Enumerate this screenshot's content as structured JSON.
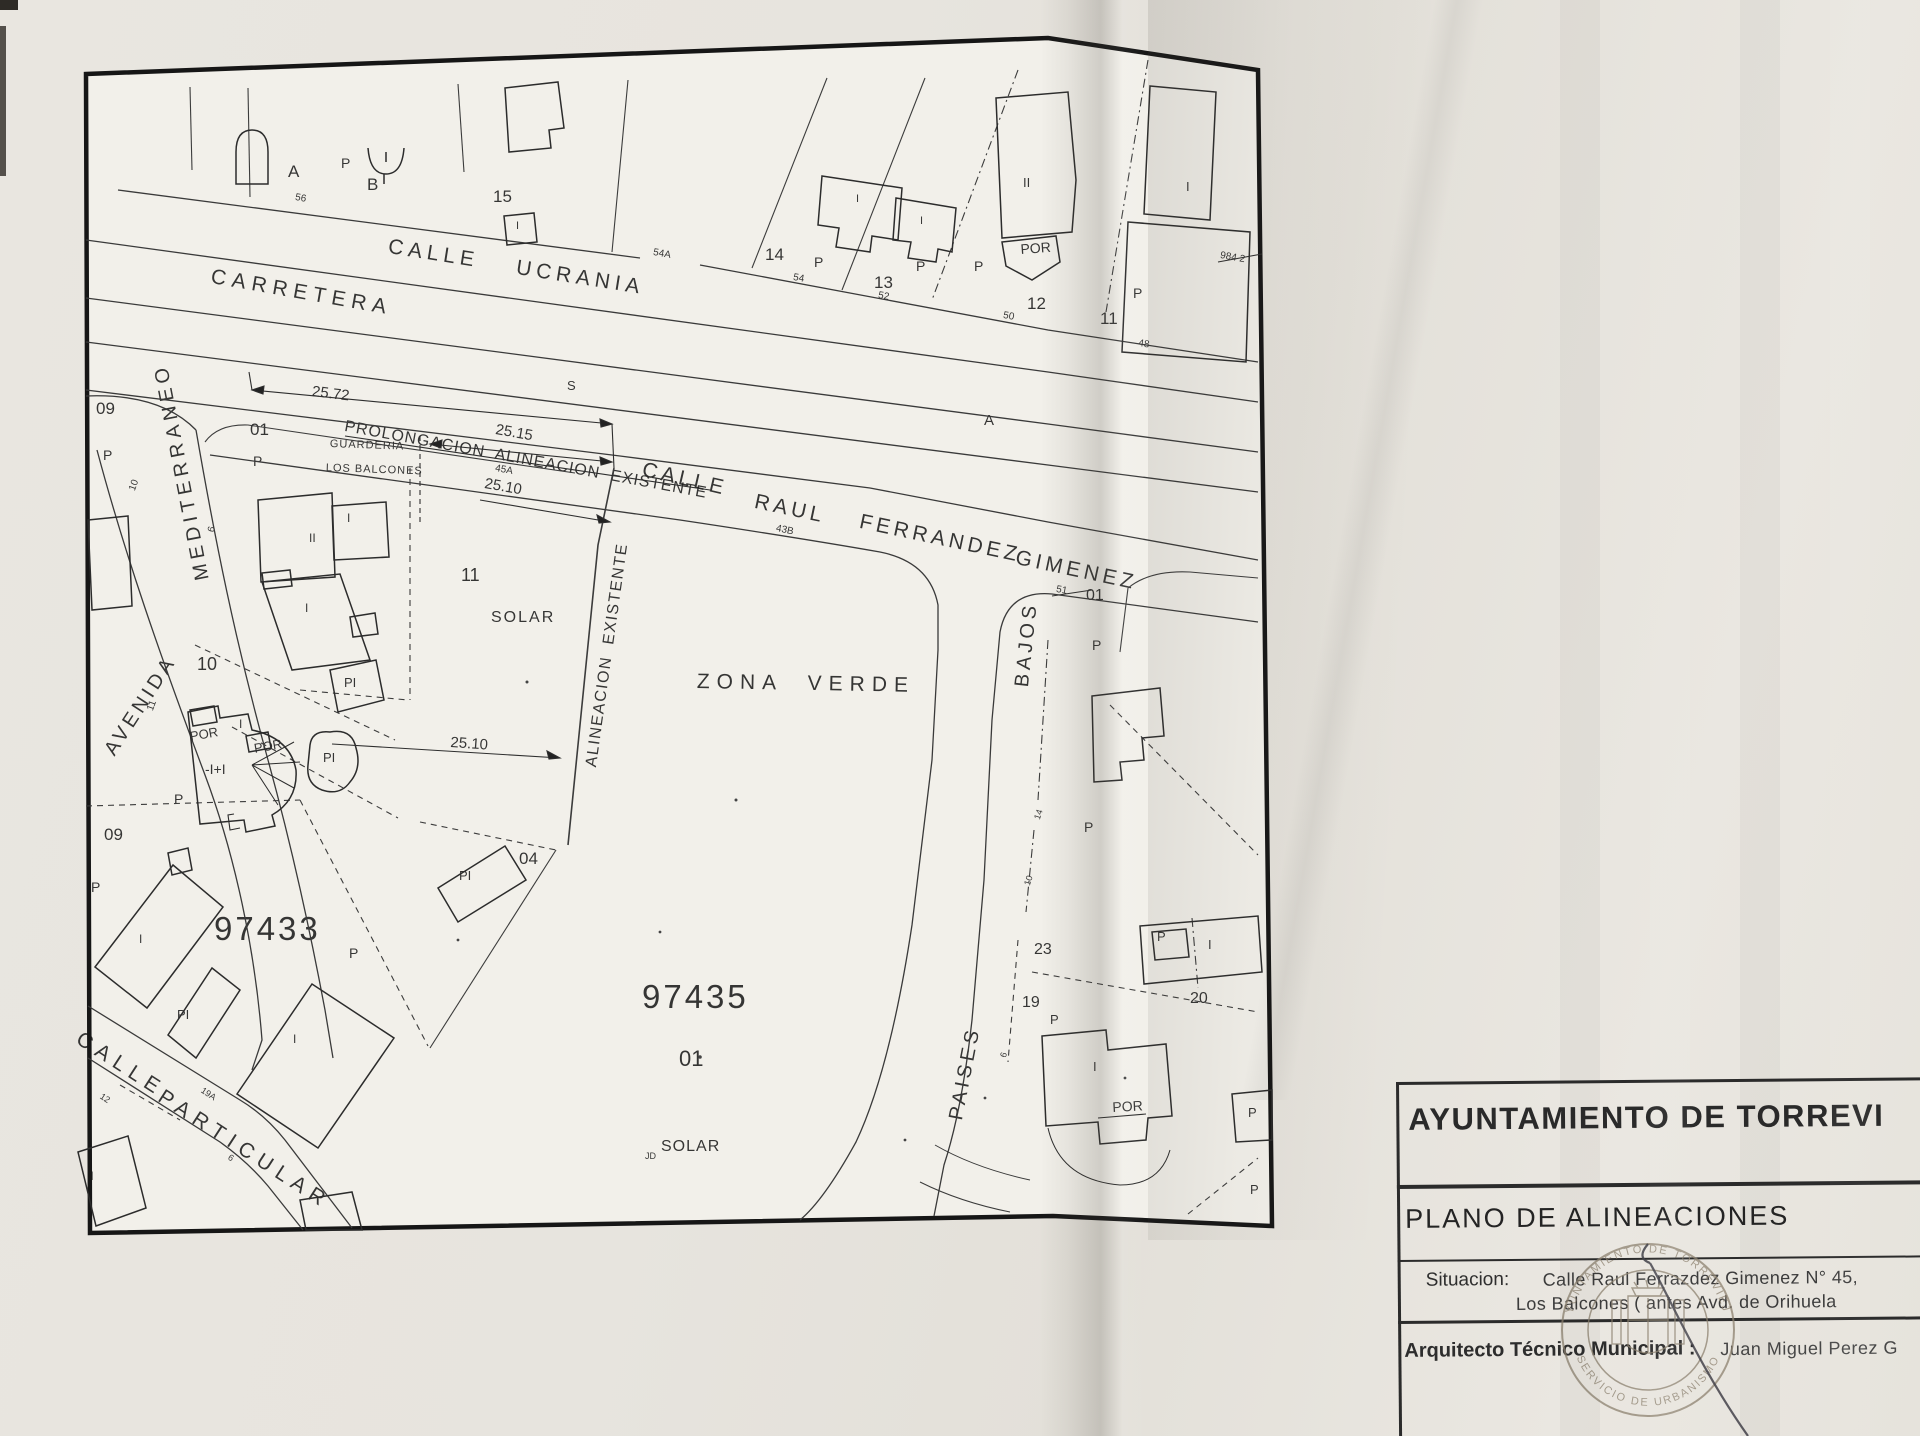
{
  "title_block": {
    "organization": "AYUNTAMIENTO DE TORREVI",
    "plan_title": "PLANO DE ALINEACIONES",
    "situacion_label": "Situacion:",
    "situacion_line1": "Calle Raul Ferrazdez Gimenez N° 45,",
    "situacion_line2": "Los Balcones ( antes Avd. de Orihuela",
    "arquitecto_label": "Arquitecto Técnico Municipal :",
    "arquitecto_name": "Juan Miguel Perez G"
  },
  "stamp": {
    "top_text": "AYUNTAMIENTO DE TORREVIEJA",
    "bottom_text": "SERVICIO DE URBANISMO"
  },
  "map_labels": [
    {
      "n": "street-carretera",
      "t": "CARRETERA",
      "x": 213,
      "y": 266,
      "r": 10,
      "s": 21,
      "ls": 6
    },
    {
      "n": "street-ucrania-calle",
      "t": "CALLE",
      "x": 390,
      "y": 236,
      "r": 9,
      "s": 21,
      "ls": 5
    },
    {
      "n": "street-ucrania-ucrania",
      "t": "UCRANIA",
      "x": 518,
      "y": 257,
      "r": 9,
      "s": 21,
      "ls": 5
    },
    {
      "n": "street-raul-calle",
      "t": "CALLE",
      "x": 645,
      "y": 459,
      "r": 13,
      "s": 21,
      "ls": 4
    },
    {
      "n": "street-raul-raul",
      "t": "RAUL",
      "x": 757,
      "y": 491,
      "r": 12,
      "s": 21,
      "ls": 4
    },
    {
      "n": "street-raul-ferrandez",
      "t": "FERRANDEZ",
      "x": 862,
      "y": 511,
      "r": 12,
      "s": 21,
      "ls": 4
    },
    {
      "n": "street-gimenez",
      "t": "GIMENEZ",
      "x": 1018,
      "y": 547,
      "r": 12,
      "s": 21,
      "ls": 4
    },
    {
      "n": "street-avenida",
      "t": "AVENIDA",
      "x": 101,
      "y": 748,
      "r": -57,
      "s": 20,
      "ls": 4
    },
    {
      "n": "street-mediterraneo",
      "t": "MEDITERRANEO",
      "x": 193,
      "y": 582,
      "r": -101,
      "s": 20,
      "ls": 5
    },
    {
      "n": "street-particular-calle",
      "t": "CALLE",
      "x": 84,
      "y": 1028,
      "r": 33,
      "s": 21,
      "ls": 7
    },
    {
      "n": "street-particular-particular",
      "t": "PARTICULAR",
      "x": 166,
      "y": 1086,
      "r": 33,
      "s": 21,
      "ls": 7
    },
    {
      "n": "street-paises",
      "t": "PAISES",
      "x": 946,
      "y": 1118,
      "r": -79,
      "s": 20,
      "ls": 4
    },
    {
      "n": "street-bajos",
      "t": "BAJOS",
      "x": 1012,
      "y": 686,
      "r": -84,
      "s": 20,
      "ls": 4
    },
    {
      "n": "area-zona-verde",
      "t": "ZONA  VERDE",
      "x": 697,
      "y": 671,
      "r": 1,
      "s": 21,
      "ls": 7
    },
    {
      "n": "label-prolongacion-alineacion",
      "t": "PROLONGACION  ALINEACION  EXISTENTE",
      "x": 346,
      "y": 419,
      "r": 10.5,
      "s": 16,
      "ls": 1
    },
    {
      "n": "label-alineacion-existente",
      "t": "ALINEACION  EXISTENTE",
      "x": 584,
      "y": 766,
      "r": -82,
      "s": 16,
      "ls": 1.5
    },
    {
      "n": "ref-97433",
      "t": "97433",
      "x": 214,
      "y": 912,
      "r": 0,
      "s": 33,
      "ls": 3
    },
    {
      "n": "ref-97435",
      "t": "97435",
      "x": 642,
      "y": 980,
      "r": 0,
      "s": 33,
      "ls": 3
    },
    {
      "n": "lot-97435-01",
      "t": "01",
      "x": 679,
      "y": 1048,
      "r": 0,
      "s": 22
    },
    {
      "n": "label-solar-97435",
      "t": "SOLAR",
      "x": 661,
      "y": 1139,
      "r": 0,
      "s": 16,
      "ls": 1
    },
    {
      "n": "label-jd",
      "t": "JD",
      "x": 645,
      "y": 1152,
      "r": 0,
      "s": 9
    },
    {
      "n": "label-guarderia",
      "t": "GUARDERIA",
      "x": 330,
      "y": 439,
      "r": 2,
      "s": 11,
      "ls": 1
    },
    {
      "n": "label-los-balcones",
      "t": "LOS BALCONES",
      "x": 326,
      "y": 463,
      "r": 2,
      "s": 11,
      "ls": 1
    },
    {
      "n": "lot-11-solar",
      "t": "11",
      "x": 461,
      "y": 566,
      "r": 0,
      "s": 18
    },
    {
      "n": "label-solar-11",
      "t": "SOLAR",
      "x": 491,
      "y": 610,
      "r": 0,
      "s": 16,
      "ls": 2
    },
    {
      "n": "dim-25-72",
      "t": "25.72",
      "x": 313,
      "y": 384,
      "r": 7,
      "s": 15
    },
    {
      "n": "dim-25-15",
      "t": "25.15",
      "x": 497,
      "y": 422,
      "r": 10,
      "s": 15
    },
    {
      "n": "dim-25-10-top",
      "t": "25.10",
      "x": 486,
      "y": 476,
      "r": 10,
      "s": 15
    },
    {
      "n": "dim-25-10-bottom",
      "t": "25.10",
      "x": 451,
      "y": 735,
      "r": 4,
      "s": 15
    },
    {
      "n": "tick-45a",
      "t": "45A",
      "x": 496,
      "y": 464,
      "r": 10,
      "s": 10
    },
    {
      "n": "tick-43b",
      "t": "43B",
      "x": 777,
      "y": 524,
      "r": 12,
      "s": 10
    },
    {
      "n": "tick-56",
      "t": "56",
      "x": 296,
      "y": 193,
      "r": 10,
      "s": 10
    },
    {
      "n": "tick-54a",
      "t": "54A",
      "x": 654,
      "y": 248,
      "r": 10,
      "s": 10
    },
    {
      "n": "tick-54",
      "t": "54",
      "x": 794,
      "y": 273,
      "r": 10,
      "s": 10
    },
    {
      "n": "tick-52",
      "t": "52",
      "x": 879,
      "y": 291,
      "r": 10,
      "s": 10
    },
    {
      "n": "tick-50",
      "t": "50",
      "x": 1004,
      "y": 311,
      "r": 10,
      "s": 10
    },
    {
      "n": "tick-48",
      "t": "48",
      "x": 1139,
      "y": 339,
      "r": 8,
      "s": 10
    },
    {
      "n": "tick-51",
      "t": "51",
      "x": 1057,
      "y": 585,
      "r": 10,
      "s": 10
    },
    {
      "n": "tick-984-2",
      "t": "984 2",
      "x": 1221,
      "y": 251,
      "r": 10,
      "s": 10
    },
    {
      "n": "letter-s",
      "t": "S",
      "x": 567,
      "y": 379,
      "r": 0,
      "s": 13
    },
    {
      "n": "letter-a",
      "t": "A",
      "x": 984,
      "y": 413,
      "r": 0,
      "s": 15
    },
    {
      "n": "label-a-top",
      "t": "A",
      "x": 288,
      "y": 163,
      "r": 0,
      "s": 17
    },
    {
      "n": "label-p-ab",
      "t": "P",
      "x": 341,
      "y": 156,
      "r": 0,
      "s": 14
    },
    {
      "n": "label-b-top",
      "t": "B",
      "x": 367,
      "y": 176,
      "r": 0,
      "s": 17
    },
    {
      "n": "lot-15",
      "t": "15",
      "x": 493,
      "y": 188,
      "r": 0,
      "s": 17
    },
    {
      "n": "bld-i-15",
      "t": "I",
      "x": 516,
      "y": 221,
      "r": 0,
      "s": 11
    },
    {
      "n": "lot-14",
      "t": "14",
      "x": 765,
      "y": 246,
      "r": 0,
      "s": 17
    },
    {
      "n": "label-p-14",
      "t": "P",
      "x": 814,
      "y": 255,
      "r": 0,
      "s": 14
    },
    {
      "n": "lot-13",
      "t": "13",
      "x": 874,
      "y": 274,
      "r": 0,
      "s": 17
    },
    {
      "n": "label-p-13",
      "t": "P",
      "x": 916,
      "y": 259,
      "r": 0,
      "s": 14
    },
    {
      "n": "label-p-12",
      "t": "P",
      "x": 974,
      "y": 259,
      "r": 0,
      "s": 14
    },
    {
      "n": "lot-12",
      "t": "12",
      "x": 1027,
      "y": 295,
      "r": 0,
      "s": 17
    },
    {
      "n": "bld-por-12",
      "t": "POR",
      "x": 1020,
      "y": 242,
      "r": -4,
      "s": 14
    },
    {
      "n": "bld-ii-12",
      "t": "II",
      "x": 1023,
      "y": 176,
      "r": 0,
      "s": 13
    },
    {
      "n": "bld-i-14a",
      "t": "I",
      "x": 856,
      "y": 194,
      "r": 0,
      "s": 11
    },
    {
      "n": "bld-i-14b",
      "t": "I",
      "x": 920,
      "y": 216,
      "r": 0,
      "s": 11
    },
    {
      "n": "lot-11-street",
      "t": "11",
      "x": 1100,
      "y": 310,
      "r": 0,
      "s": 17
    },
    {
      "n": "label-p-11",
      "t": "P",
      "x": 1133,
      "y": 286,
      "r": 0,
      "s": 14
    },
    {
      "n": "bld-i-topright",
      "t": "I",
      "x": 1186,
      "y": 180,
      "r": 0,
      "s": 13
    },
    {
      "n": "lot-09-top",
      "t": "09",
      "x": 96,
      "y": 400,
      "r": 0,
      "s": 17
    },
    {
      "n": "label-p-09top",
      "t": "P",
      "x": 103,
      "y": 448,
      "r": 0,
      "s": 14
    },
    {
      "n": "tick-10-med",
      "t": "10",
      "x": 128,
      "y": 489,
      "r": -70,
      "s": 10
    },
    {
      "n": "tick-6-med",
      "t": "6",
      "x": 207,
      "y": 531,
      "r": -75,
      "s": 10
    },
    {
      "n": "tick-11-med",
      "t": "11",
      "x": 146,
      "y": 709,
      "r": -70,
      "s": 10
    },
    {
      "n": "lot-01-guarderia",
      "t": "01",
      "x": 250,
      "y": 421,
      "r": 0,
      "s": 17
    },
    {
      "n": "label-p-01",
      "t": "P",
      "x": 253,
      "y": 454,
      "r": 0,
      "s": 14
    },
    {
      "n": "lot-10",
      "t": "10",
      "x": 197,
      "y": 655,
      "r": 0,
      "s": 18
    },
    {
      "n": "lot-09-mid",
      "t": "09",
      "x": 104,
      "y": 826,
      "r": 0,
      "s": 17
    },
    {
      "n": "label-p-09mid",
      "t": "P",
      "x": 91,
      "y": 880,
      "r": 0,
      "s": 14
    },
    {
      "n": "bld-ii-guard",
      "t": "II",
      "x": 309,
      "y": 532,
      "r": 0,
      "s": 12
    },
    {
      "n": "bld-i-guard1",
      "t": "I",
      "x": 347,
      "y": 512,
      "r": 0,
      "s": 12
    },
    {
      "n": "bld-i-guard2",
      "t": "I",
      "x": 305,
      "y": 602,
      "r": 0,
      "s": 12
    },
    {
      "n": "bld-pi-1",
      "t": "PI",
      "x": 344,
      "y": 676,
      "r": 0,
      "s": 13
    },
    {
      "n": "bld-pi-2",
      "t": "PI",
      "x": 323,
      "y": 751,
      "r": 0,
      "s": 13
    },
    {
      "n": "bld-por-1",
      "t": "POR",
      "x": 189,
      "y": 730,
      "r": -10,
      "s": 13
    },
    {
      "n": "bld-por-2",
      "t": "POR",
      "x": 253,
      "y": 742,
      "r": -10,
      "s": 13
    },
    {
      "n": "bld-i-10",
      "t": "I",
      "x": 239,
      "y": 718,
      "r": 0,
      "s": 12
    },
    {
      "n": "bld-minus-i",
      "t": "-I+I",
      "x": 205,
      "y": 762,
      "r": 0,
      "s": 14
    },
    {
      "n": "label-p-10",
      "t": "P",
      "x": 174,
      "y": 792,
      "r": 0,
      "s": 14
    },
    {
      "n": "lot-04",
      "t": "04",
      "x": 519,
      "y": 850,
      "r": 0,
      "s": 17
    },
    {
      "n": "bld-pi-04",
      "t": "PI",
      "x": 459,
      "y": 869,
      "r": 0,
      "s": 13
    },
    {
      "n": "label-p-97433",
      "t": "P",
      "x": 349,
      "y": 946,
      "r": 0,
      "s": 14
    },
    {
      "n": "bld-i-97433a",
      "t": "I",
      "x": 139,
      "y": 933,
      "r": 0,
      "s": 12
    },
    {
      "n": "bld-pi-97433",
      "t": "PI",
      "x": 177,
      "y": 1008,
      "r": 0,
      "s": 13
    },
    {
      "n": "bld-i-97433b",
      "t": "I",
      "x": 293,
      "y": 1033,
      "r": 0,
      "s": 12
    },
    {
      "n": "bld-ii-bottomleft",
      "t": "II",
      "x": 87,
      "y": 1170,
      "r": 0,
      "s": 12
    },
    {
      "n": "tick-19a",
      "t": "19A",
      "x": 204,
      "y": 1086,
      "r": 33,
      "s": 9
    },
    {
      "n": "tick-12-part",
      "t": "12",
      "x": 103,
      "y": 1092,
      "r": 33,
      "s": 9
    },
    {
      "n": "tick-6-part",
      "t": "6",
      "x": 231,
      "y": 1153,
      "r": 33,
      "s": 9
    },
    {
      "n": "lot-01-right",
      "t": "01",
      "x": 1086,
      "y": 588,
      "r": 0,
      "s": 16
    },
    {
      "n": "label-p-01right",
      "t": "P",
      "x": 1092,
      "y": 638,
      "r": 0,
      "s": 14
    },
    {
      "n": "label-p-right2",
      "t": "P",
      "x": 1084,
      "y": 820,
      "r": 0,
      "s": 14
    },
    {
      "n": "lot-23",
      "t": "23",
      "x": 1034,
      "y": 942,
      "r": 0,
      "s": 16
    },
    {
      "n": "lot-19",
      "t": "19",
      "x": 1022,
      "y": 995,
      "r": 0,
      "s": 16
    },
    {
      "n": "label-p-19",
      "t": "P",
      "x": 1050,
      "y": 1013,
      "r": 0,
      "s": 13
    },
    {
      "n": "tick-14-pb",
      "t": "14",
      "x": 1033,
      "y": 818,
      "r": -72,
      "s": 9
    },
    {
      "n": "tick-10-pb",
      "t": "10",
      "x": 1023,
      "y": 884,
      "r": -72,
      "s": 9
    },
    {
      "n": "tick-6-pb",
      "t": "6",
      "x": 999,
      "y": 1056,
      "r": -72,
      "s": 9
    },
    {
      "n": "lot-20",
      "t": "20",
      "x": 1190,
      "y": 991,
      "r": 0,
      "s": 16
    },
    {
      "n": "bld-p-box",
      "t": "P",
      "x": 1157,
      "y": 930,
      "r": 0,
      "s": 13
    },
    {
      "n": "bld-i-20",
      "t": "I",
      "x": 1208,
      "y": 938,
      "r": 0,
      "s": 13
    },
    {
      "n": "bld-i-19",
      "t": "I",
      "x": 1093,
      "y": 1060,
      "r": 0,
      "s": 13
    },
    {
      "n": "bld-por-19",
      "t": "POR",
      "x": 1112,
      "y": 1100,
      "r": -3,
      "s": 14
    },
    {
      "n": "bld-p-frag",
      "t": "P",
      "x": 1248,
      "y": 1106,
      "r": 0,
      "s": 13
    },
    {
      "n": "label-p-bottomright",
      "t": "P",
      "x": 1250,
      "y": 1183,
      "r": 0,
      "s": 13
    }
  ]
}
